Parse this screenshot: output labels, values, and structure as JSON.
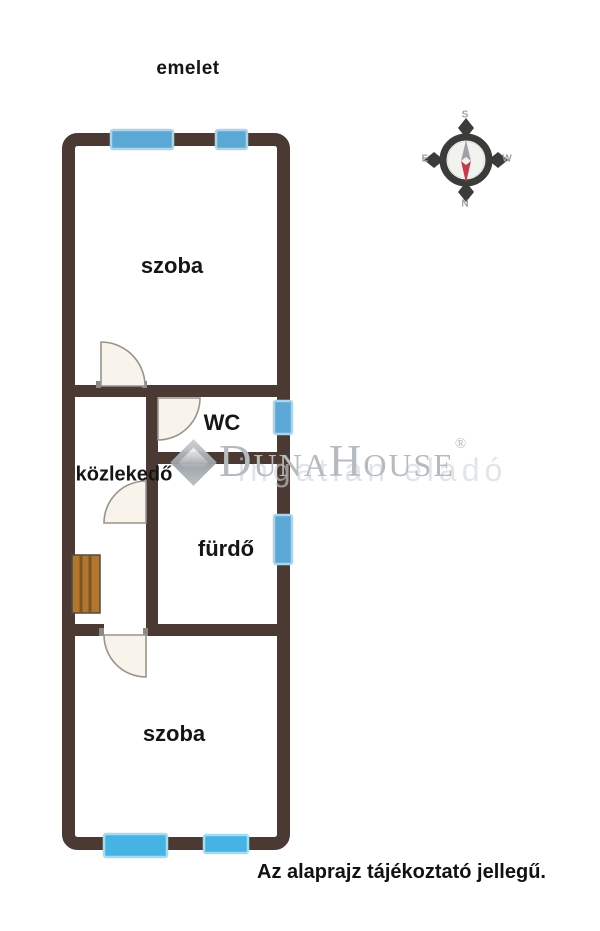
{
  "title": "emelet",
  "disclaimer": "Az alaprajz tájékoztató jellegű.",
  "rooms": [
    {
      "id": "szoba-felso",
      "label": "szoba"
    },
    {
      "id": "wc",
      "label": "WC"
    },
    {
      "id": "kozlekedo",
      "label": "közlekedő"
    },
    {
      "id": "furdo",
      "label": "fürdő"
    },
    {
      "id": "szoba-also",
      "label": "szoba"
    }
  ],
  "compass": {
    "top": "S",
    "bottom": "N",
    "left": "E",
    "right": "W"
  },
  "watermark": {
    "brand": "DunaHouse",
    "registered": "®",
    "faint_text": "ingatlan eladó"
  },
  "counts": {
    "windows": 6,
    "doors": 4
  },
  "colors": {
    "wall": "#4a3a33",
    "window_fill": "#5ba7d5",
    "window_fill_bright": "#45b3e3",
    "window_border": "#aed4ea",
    "door_fill": "#f8f4eb",
    "door_stroke": "#98948c",
    "radiator_fill": "#b3762e",
    "radiator_stripe": "#7d5520",
    "compass_north_red": "#c23a50",
    "compass_gray": "#a0a0a8",
    "watermark_gray": "#b6bbbf",
    "text": "#111111"
  }
}
